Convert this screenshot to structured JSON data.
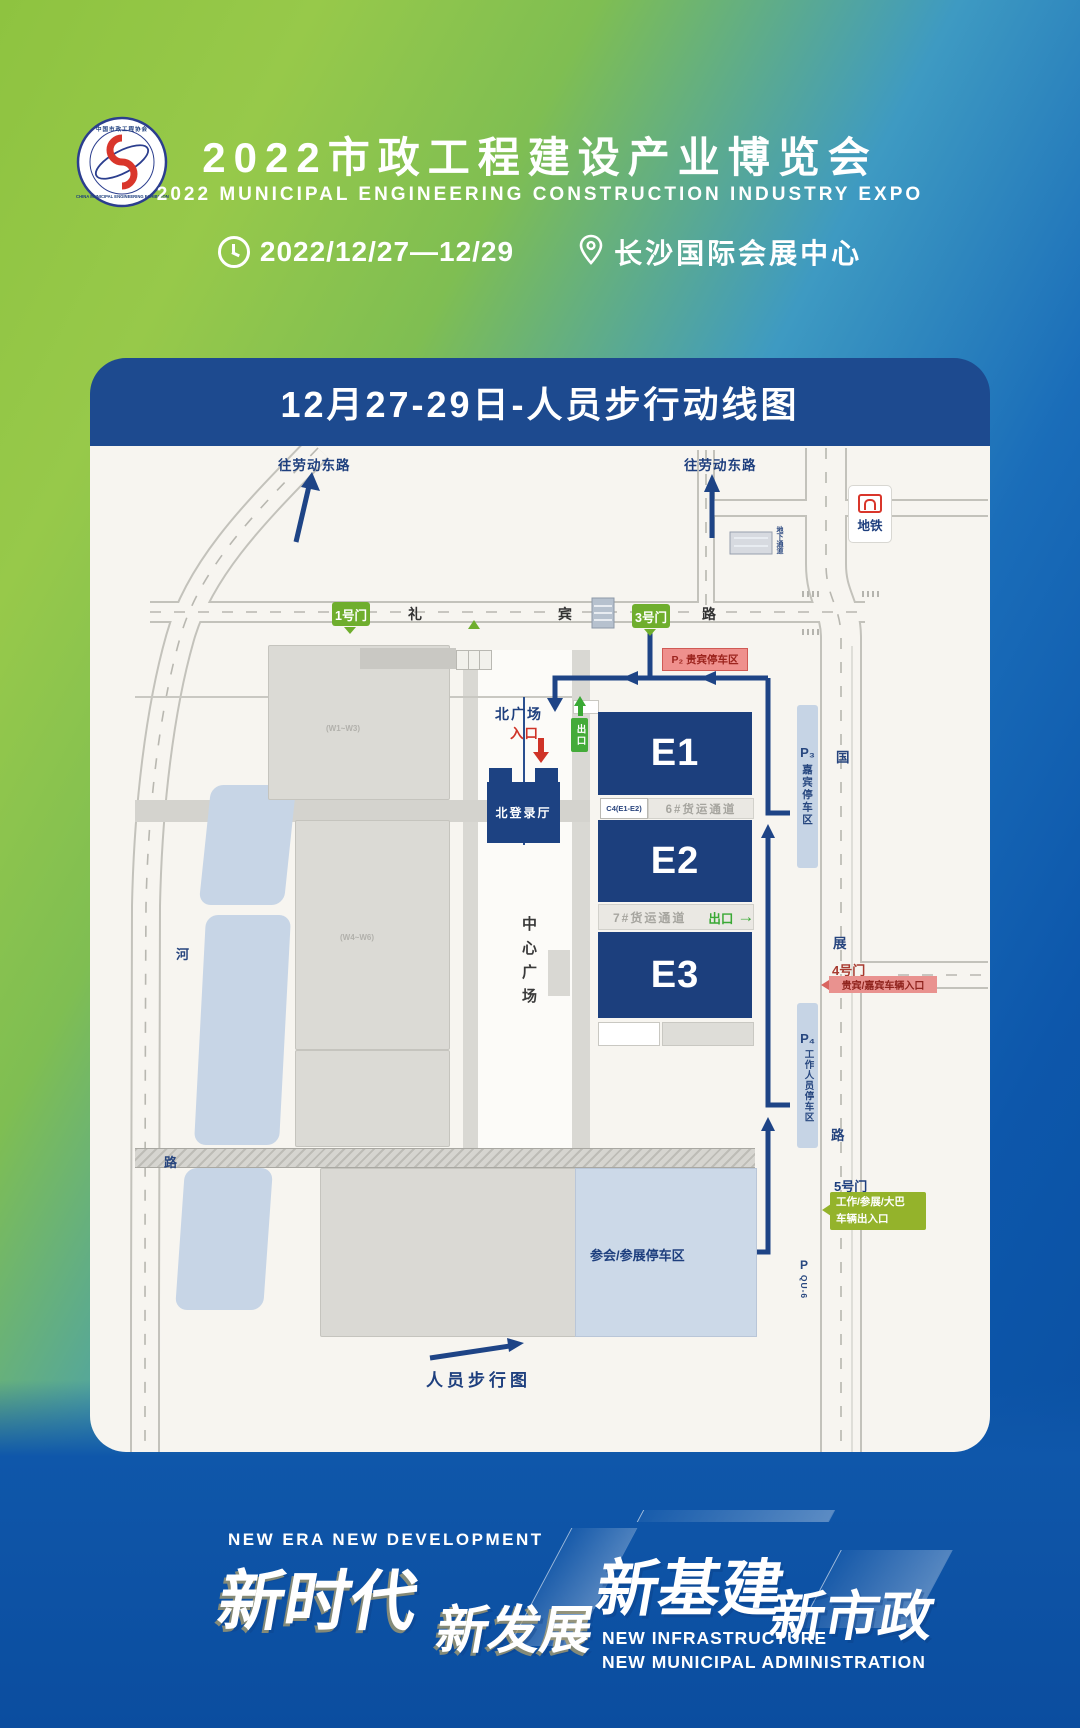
{
  "header": {
    "logo": {
      "arc_top": "中国市政工程协会",
      "arc_bottom": "CHINA MUNICIPAL ENGINEERING EXHIBITION"
    },
    "title": "2022市政工程建设产业博览会",
    "subtitle": "2022 MUNICIPAL ENGINEERING CONSTRUCTION INDUSTRY EXPO",
    "date": "2022/12/27—12/29",
    "venue": "长沙国际会展中心"
  },
  "map": {
    "bar_title": "12月27-29日-人员步行动线图",
    "colors": {
      "title_bar_navy": "#1d4a8f",
      "hall_navy": "#1c3f7d",
      "route_navy": "#1e4486",
      "gate_green": "#6fae2d",
      "exit_green": "#3aa935",
      "gate5_olive": "#94b32b",
      "entry_red": "#cf3327",
      "p2_label_bg": "#ef908d",
      "parking_blue": "#c6d4e5"
    },
    "roads": {
      "to_laodong_left": "往劳动东路",
      "to_laodong_right": "往劳动东路",
      "libin": [
        "礼",
        "宾",
        "路"
      ],
      "guozhan": [
        "国",
        "展",
        "路"
      ],
      "he": [
        "河",
        "路"
      ],
      "underpass": "地下通道",
      "metro": "地铁"
    },
    "gates": {
      "g1": "1号门",
      "g3": "3号门",
      "g4": "4号门",
      "g4_label": "贵宾/嘉宾车辆入口",
      "g5": "5号门",
      "g5_line1": "工作/参展/大巴",
      "g5_line2": "车辆出入口"
    },
    "halls": {
      "e1": "E1",
      "e2": "E2",
      "e3": "E3",
      "north_login": "北登录厅",
      "c4": "C4(E1-E2)",
      "freight6": "6#货运通道",
      "freight7": "7#货运通道",
      "center_plaza": "中心广场",
      "west_upper": "(W1~W3)",
      "west_lower": "(W4~W6)"
    },
    "north_square": {
      "label": "北广场",
      "entry": "入口",
      "exit_badge": "出口",
      "exit_east": "出口"
    },
    "parking": {
      "p2": "P₂ 贵宾停车区",
      "p3": "P₃",
      "p3_label": "嘉宾停车区",
      "p4": "P₄",
      "p4_label": "工作人员停车区",
      "attendee": "参会/参展停车区",
      "pq": "P",
      "pq_code": "QU-6"
    },
    "legend": "人员步行图"
  },
  "footer": {
    "tagline_en": "NEW ERA  NEW DEVELOPMENT",
    "big1": "新时代",
    "big2": "新发展",
    "big3": "新基建",
    "big4": "新市政",
    "sub1": "NEW INFRASTRUCTURE",
    "sub2": "NEW MUNICIPAL ADMINISTRATION"
  }
}
